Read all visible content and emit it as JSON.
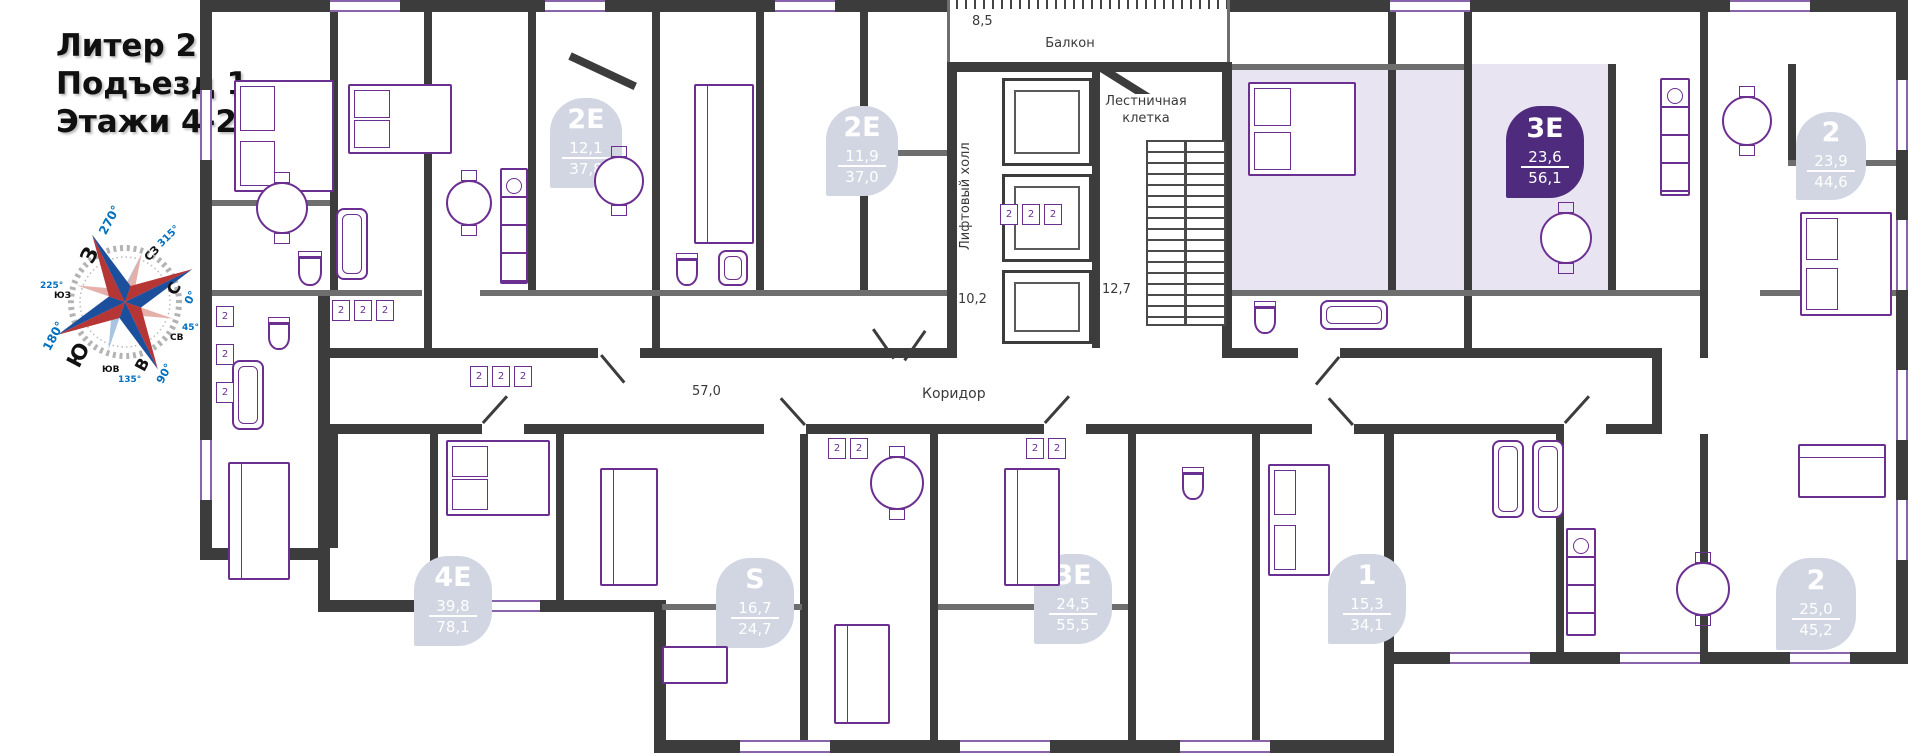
{
  "header": {
    "line1": "Литер 2",
    "line2": "Подъезд 1",
    "line3": "Этажи 4-24"
  },
  "compass": {
    "n": "С",
    "ne": "СВ",
    "e": "В",
    "se": "ЮВ",
    "s": "Ю",
    "sw": "ЮЗ",
    "w": "З",
    "nw": "СЗ",
    "deg0": "0°",
    "deg45": "45°",
    "deg90": "90°",
    "deg135": "135°",
    "deg180": "180°",
    "deg225": "225°",
    "deg270": "270°",
    "deg315": "315°",
    "colors": {
      "red": "#b63535",
      "blue": "#1c4f9c",
      "degree_text": "#0070c0"
    }
  },
  "plan": {
    "labels": {
      "balcony": "Балкон",
      "balcony_area": "8,5",
      "stairwell": "Лестничная клетка",
      "stair_area": "12,7",
      "lift_hall": "Лифтовый холл",
      "lift_area": "10,2",
      "corridor": "Коридор",
      "corridor_area": "57,0",
      "window_mark": "2"
    },
    "apartments": [
      {
        "type": "2Е",
        "area1": "12,1",
        "area2": "37,8",
        "highlighted": false
      },
      {
        "type": "2Е",
        "area1": "11,9",
        "area2": "37,0",
        "highlighted": false
      },
      {
        "type": "3Е",
        "area1": "23,6",
        "area2": "56,1",
        "highlighted": true
      },
      {
        "type": "2",
        "area1": "23,9",
        "area2": "44,6",
        "highlighted": false
      },
      {
        "type": "4Е",
        "area1": "39,8",
        "area2": "78,1",
        "highlighted": false
      },
      {
        "type": "S",
        "area1": "16,7",
        "area2": "24,7",
        "highlighted": false
      },
      {
        "type": "3Е",
        "area1": "24,5",
        "area2": "55,5",
        "highlighted": false
      },
      {
        "type": "1",
        "area1": "15,3",
        "area2": "34,1",
        "highlighted": false
      },
      {
        "type": "2",
        "area1": "25,0",
        "area2": "45,2",
        "highlighted": false
      }
    ],
    "colors": {
      "wall": "#3c3c3c",
      "furniture_line": "#6b2e91",
      "badge_bg": "#d2d6e2",
      "badge_selected_bg": "#4f2b7e",
      "badge_text": "#ffffff",
      "highlight_fill": "#e9e4f1",
      "label_text": "#3a3a3a"
    }
  }
}
